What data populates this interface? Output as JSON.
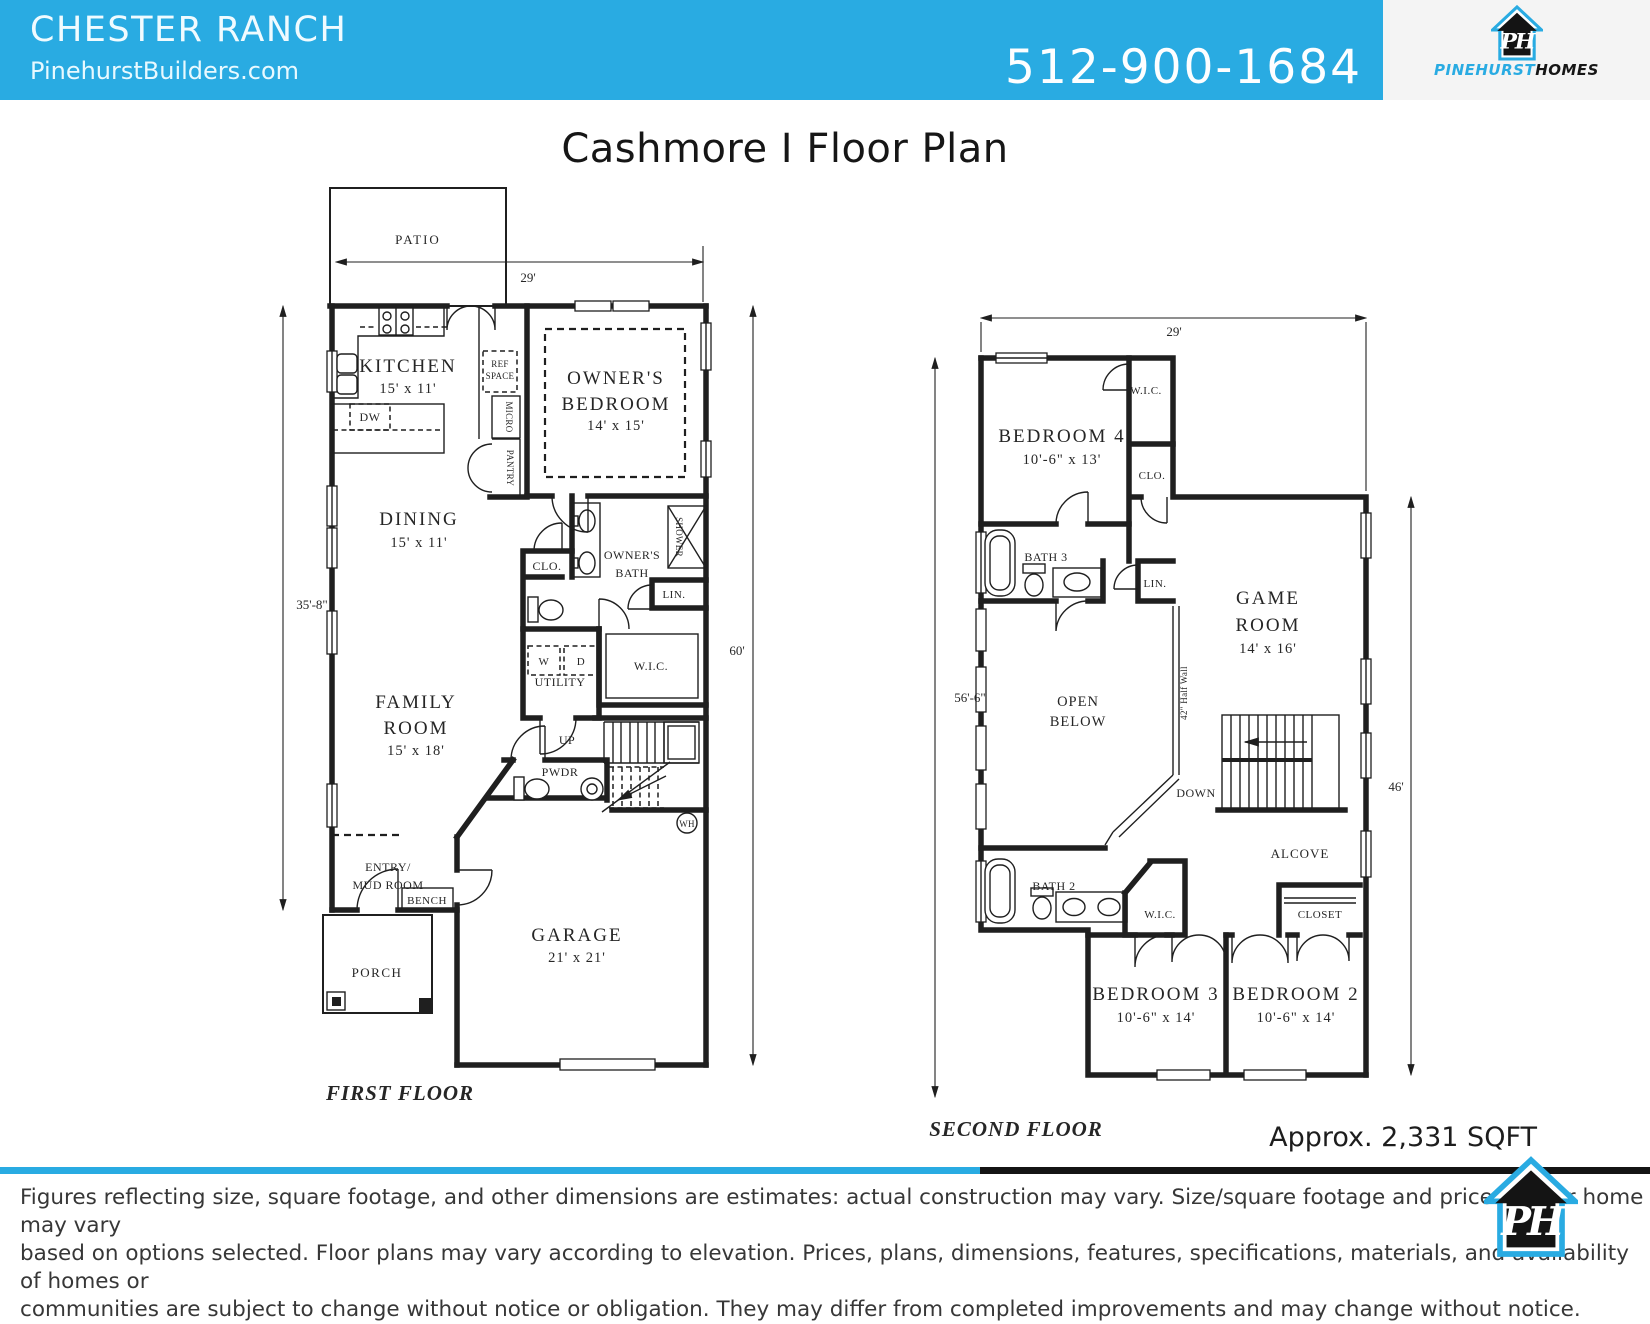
{
  "header": {
    "community": "CHESTER RANCH",
    "website": "PinehurstBuilders.com",
    "phone": "512-900-1684",
    "brand": {
      "word1": "PINEHURST",
      "word2": "HOMES",
      "monogram": "PH"
    },
    "accent_color": "#29abe2"
  },
  "title": "Cashmore I Floor Plan",
  "sqft": "Approx. 2,331 SQFT",
  "floors": {
    "first": {
      "label": "FIRST FLOOR",
      "dims": {
        "width": "29'",
        "left": "35'-8\"",
        "right": "60'"
      },
      "rooms": {
        "patio": "PATIO",
        "kitchen": "KITCHEN",
        "kitchen_size": "15' x 11'",
        "ref1": "REF",
        "ref2": "SPACE",
        "micro": "MICRO",
        "pantry": "PANTRY",
        "dw": "DW",
        "owners1": "OWNER'S",
        "owners2": "BEDROOM",
        "owners_size": "14' x 15'",
        "dining": "DINING",
        "dining_size": "15' x 11'",
        "bath1": "OWNER'S",
        "bath2": "BATH",
        "shower": "SHOWER",
        "clo": "CLO.",
        "lin": "LIN.",
        "wic": "W.I.C.",
        "w": "W",
        "d": "D",
        "utility": "UTILITY",
        "family1": "FAMILY",
        "family2": "ROOM",
        "family_size": "15' x 18'",
        "up": "UP",
        "pwdr": "PWDR",
        "wh": "WH",
        "entry1": "ENTRY/",
        "entry2": "MUD ROOM",
        "bench": "BENCH",
        "porch": "PORCH",
        "garage": "GARAGE",
        "garage_size": "21' x 21'"
      }
    },
    "second": {
      "label": "SECOND FLOOR",
      "dims": {
        "width": "29'",
        "left": "56'-6\"",
        "right": "46'"
      },
      "rooms": {
        "bedroom4": "BEDROOM 4",
        "bedroom4_size": "10'-6\" x 13'",
        "wic": "W.I.C.",
        "clo": "CLO.",
        "bath3": "BATH 3",
        "lin": "LIN.",
        "game1": "GAME",
        "game2": "ROOM",
        "game_size": "14' x 16'",
        "open1": "OPEN",
        "open2": "BELOW",
        "halfwall": "42\" Half Wall",
        "down": "DOWN",
        "alcove": "ALCOVE",
        "bath2": "BATH 2",
        "wic2": "W.I.C.",
        "closet": "CLOSET",
        "bedroom3": "BEDROOM 3",
        "bedroom3_size": "10'-6\" x 14'",
        "bedroom2": "BEDROOM 2",
        "bedroom2_size": "10'-6\" x 14'"
      }
    }
  },
  "disclaimer": {
    "lines": [
      "Figures reflecting size, square footage, and other dimensions are estimates:  actual construction may vary.  Size/square footage and price of your home may vary",
      "based on options selected.  Floor plans may vary according to elevation.  Prices, plans, dimensions, features, specifications, materials, and availability of homes or",
      "communities are subject to change without notice or obligation.  They may differ from completed improvements and may change without notice."
    ]
  }
}
